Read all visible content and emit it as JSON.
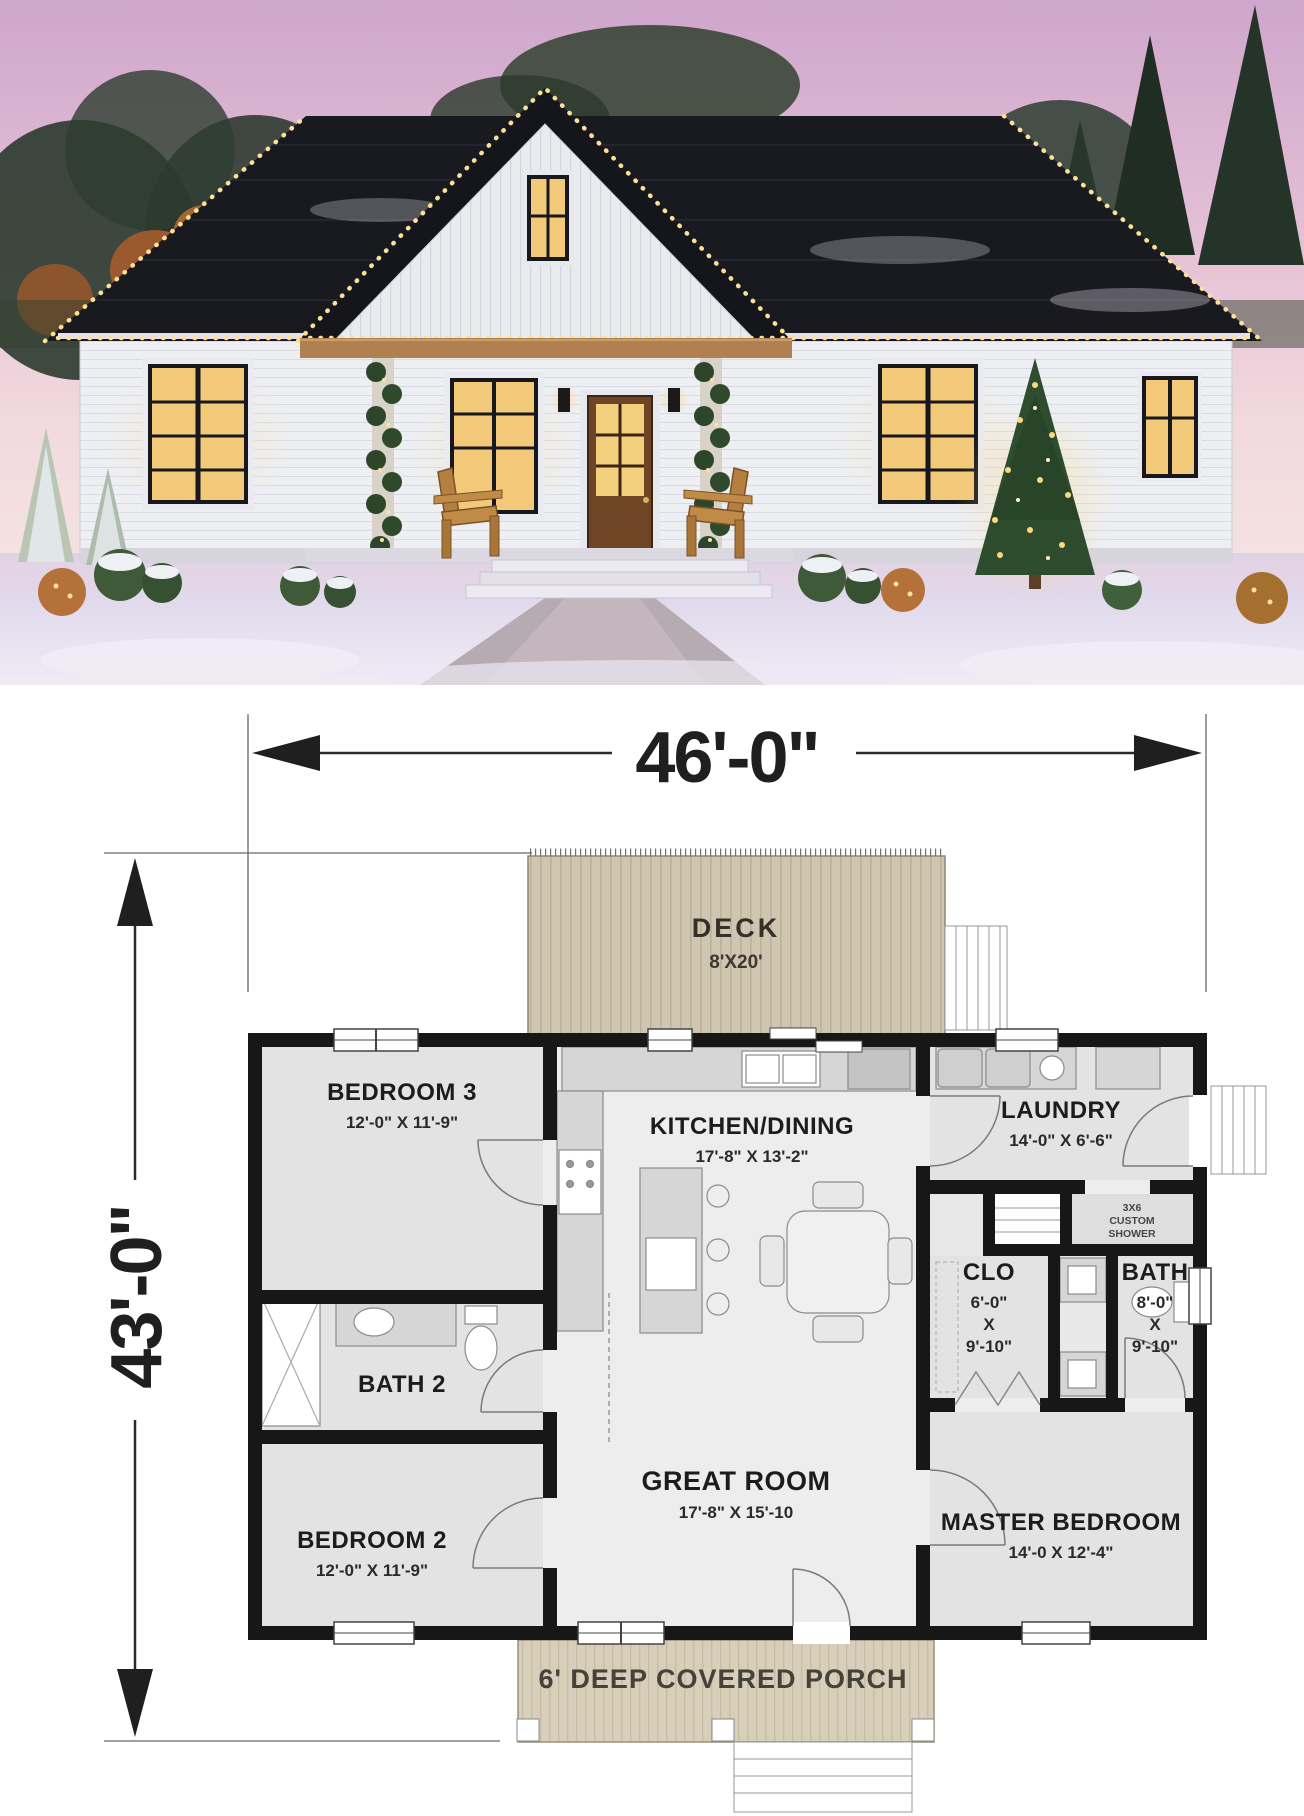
{
  "palette": {
    "wall": "#171717",
    "room_fill": "#e3e3e3",
    "deck_fill": "#cfc6b1",
    "porch_fill": "#d8cfba",
    "dim_color": "#1f1f1f",
    "window_glow": "#f2c979",
    "roof": "#191a1f"
  },
  "plan": {
    "width_dim": "46'-0\"",
    "height_dim": "43'-0\"",
    "deck": {
      "label": "DECK",
      "dims": "8'X20'"
    },
    "porch_label": "6' DEEP COVERED PORCH",
    "shower_note": {
      "l1": "3X6",
      "l2": "CUSTOM",
      "l3": "SHOWER"
    },
    "rooms": {
      "bedroom3": {
        "label": "BEDROOM 3",
        "dims": "12'-0\" X 11'-9\""
      },
      "kitchen": {
        "label": "KITCHEN/DINING",
        "dims": "17'-8\" X 13'-2\""
      },
      "laundry": {
        "label": "LAUNDRY",
        "dims": "14'-0\" X 6'-6\""
      },
      "bath2": {
        "label": "BATH 2"
      },
      "clo": {
        "label": "CLO",
        "d1": "6'-0\"",
        "d2": "X",
        "d3": "9'-10\""
      },
      "bath": {
        "label": "BATH",
        "d1": "8'-0\"",
        "d2": "X",
        "d3": "9'-10\""
      },
      "great": {
        "label": "GREAT ROOM",
        "dims": "17'-8\" X 15'-10"
      },
      "bedroom2": {
        "label": "BEDROOM 2",
        "dims": "12'-0\" X 11'-9\""
      },
      "master": {
        "label": "MASTER BEDROOM",
        "dims": "14'-0 X 12'-4\""
      }
    }
  }
}
